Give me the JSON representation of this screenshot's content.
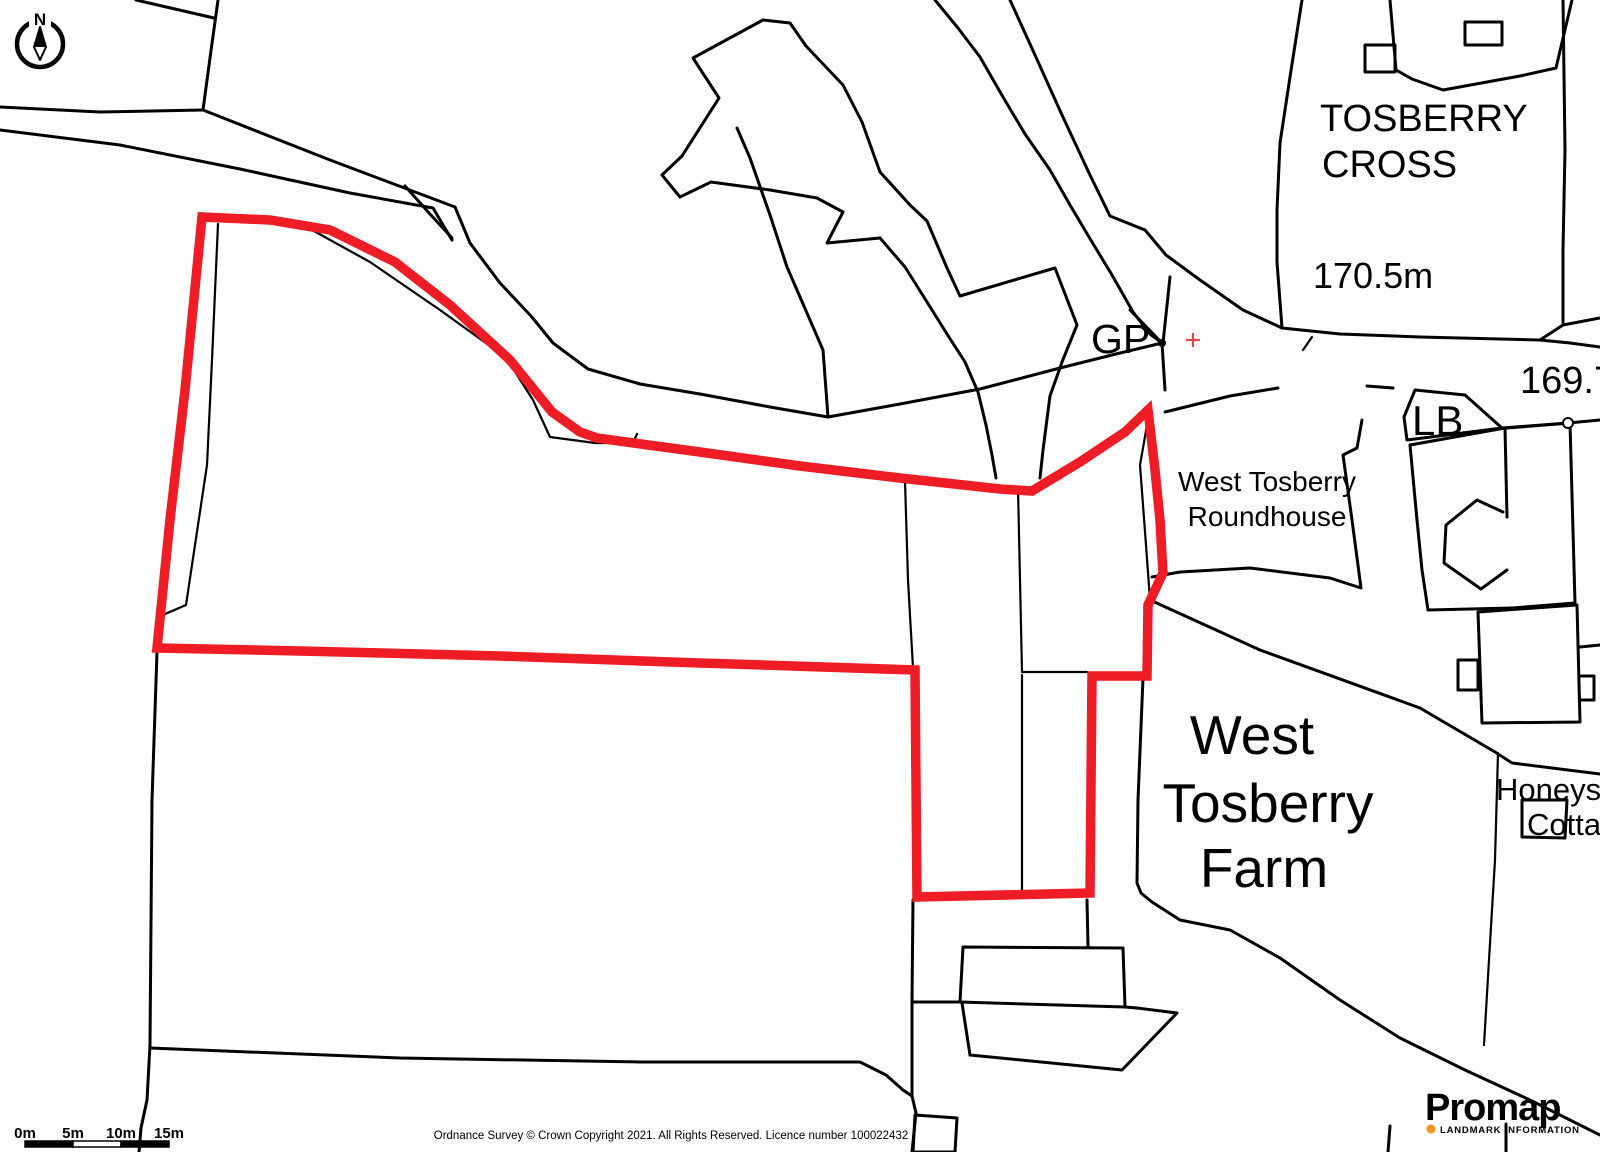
{
  "map": {
    "colors": {
      "background": "#ffffff",
      "line": "#000000",
      "boundary": "#ee1c25",
      "grid_cross": "#e2484e",
      "logo_text": "#3d3b3e",
      "logo_accent": "#f7941e"
    },
    "north_arrow": {
      "label": "N",
      "cx": 40,
      "cy": 44,
      "r": 23
    },
    "gp_dot": {
      "x": 1162,
      "y": 343,
      "r": 4
    },
    "grid_cross": {
      "x": 1193,
      "y": 340,
      "arm": 7
    },
    "post_circle": {
      "x": 1568,
      "y": 423,
      "r": 5
    },
    "labels": [
      {
        "name": "label-tosberry-cross-line1",
        "text": "TOSBERRY",
        "x": 1320,
        "y": 131,
        "size": 38
      },
      {
        "name": "label-tosberry-cross-line2",
        "text": "CROSS",
        "x": 1322,
        "y": 177,
        "size": 38
      },
      {
        "name": "label-spot-height-170",
        "text": "170.5m",
        "x": 1313,
        "y": 288,
        "size": 36
      },
      {
        "name": "label-gp",
        "text": "GP",
        "x": 1091,
        "y": 353,
        "size": 41
      },
      {
        "name": "label-spot-height-169",
        "text": "169.7m",
        "x": 1520,
        "y": 393,
        "size": 38
      },
      {
        "name": "label-lb",
        "text": "LB",
        "x": 1412,
        "y": 435,
        "size": 42
      },
      {
        "name": "label-roundhouse-line1",
        "text": "West Tosberry",
        "x": 1267,
        "y": 491,
        "size": 28,
        "anchor": "middle"
      },
      {
        "name": "label-roundhouse-line2",
        "text": "Roundhouse",
        "x": 1267,
        "y": 526,
        "size": 28,
        "anchor": "middle"
      },
      {
        "name": "label-farm-line1",
        "text": "West",
        "x": 1252,
        "y": 754,
        "size": 55,
        "anchor": "middle"
      },
      {
        "name": "label-farm-line2",
        "text": "Tosberry",
        "x": 1268,
        "y": 822,
        "size": 55,
        "anchor": "middle"
      },
      {
        "name": "label-farm-line3",
        "text": "Farm",
        "x": 1264,
        "y": 887,
        "size": 55,
        "anchor": "middle"
      },
      {
        "name": "label-honeysuckle-line1",
        "text": "Honeysuckle",
        "x": 1496,
        "y": 800,
        "size": 31
      },
      {
        "name": "label-honeysuckle-line2",
        "text": "Cottage",
        "x": 1527,
        "y": 835,
        "size": 31
      }
    ],
    "black_lines": [
      {
        "name": "field-boundary",
        "points": "218,0 210,58 203,110"
      },
      {
        "name": "field-boundary",
        "points": "136,0 175,9 214,18"
      },
      {
        "name": "road-edge",
        "points": "0,107 100,112 203,110"
      },
      {
        "name": "road-edge",
        "points": "203,110 330,160 455,207"
      },
      {
        "name": "road-edge",
        "points": "0,130 120,145 240,169 350,193 433,208 452,240"
      },
      {
        "name": "road-junction-line",
        "points": "405,186 430,214 452,238"
      },
      {
        "name": "road-edge",
        "points": "455,207 470,243 500,283 531,316 553,343 588,369 640,384 700,394 770,407 828,417"
      },
      {
        "name": "road-edge",
        "points": "828,417 900,404 980,389 1060,368 1120,353 1162,343"
      },
      {
        "name": "track-edge",
        "points": "828,417 823,350 810,320 787,267 770,215 750,158 737,128"
      },
      {
        "name": "field-boundary",
        "points": "218,224 212,360 207,465 186,605 165,614",
        "w": 2.2
      },
      {
        "name": "field-boundary",
        "points": "303,225 370,262 440,310 490,346 512,367 533,400 550,437 595,443 633,443 637,434",
        "w": 2.2
      },
      {
        "name": "pond-outline",
        "points": "763,20 693,58 719,98 682,156 662,175 680,197 711,182 770,190 817,198"
      },
      {
        "name": "pond-outline",
        "points": "763,20 790,23 806,46 843,85 862,122 880,172"
      },
      {
        "name": "stream-edge",
        "points": "880,172 910,205 927,221 947,268 960,296 1055,268 1077,325 1062,362 1050,396 1043,450 1040,478"
      },
      {
        "name": "pond-outline",
        "points": "817,198 843,212 827,243 880,238"
      },
      {
        "name": "stream-edge",
        "points": "880,238 905,267 927,302 947,334 965,362 978,392 986,425 992,455 996,478"
      },
      {
        "name": "track-edge",
        "points": "935,0 958,28 980,57 1003,97 1025,134 1050,170 1070,205 1092,242 1112,275 1133,312 1150,334 1162,343"
      },
      {
        "name": "track-edge",
        "points": "1010,0 1035,55 1062,115 1090,175 1110,216 1145,230 1166,255 1200,280 1243,310 1282,328"
      },
      {
        "name": "boundary-arm",
        "points": "1170,277 1163,343"
      },
      {
        "name": "boundary-arm",
        "points": "1130,310 1162,343"
      },
      {
        "name": "boundary-arm",
        "points": "1162,343 1165,390"
      },
      {
        "name": "parcel-edge",
        "points": "1302,0 1290,77 1280,143 1277,210 1277,262 1282,328"
      },
      {
        "name": "parcel-edge",
        "points": "1563,0 1565,150 1563,250 1563,323"
      },
      {
        "name": "road-edge",
        "points": "1282,328 1340,334 1420,337 1540,340 1563,325 1600,318"
      },
      {
        "name": "road-edge",
        "points": "1540,340 1570,343 1600,347"
      },
      {
        "name": "road-tick",
        "points": "1303,350 1312,337",
        "w": 2.2
      },
      {
        "name": "road-edge",
        "points": "1165,412 1230,396 1278,388"
      },
      {
        "name": "road-dash",
        "points": "1367,386 1393,388"
      },
      {
        "name": "road-edge",
        "points": "1502,428 1568,423 1600,420"
      },
      {
        "name": "building",
        "points": "1365,45 1395,45 1395,72 1365,72",
        "closed": true
      },
      {
        "name": "building",
        "points": "1465,22 1502,22 1502,45 1465,45",
        "closed": true
      },
      {
        "name": "building",
        "points": "1390,0 1396,70 1412,79 1443,90 1520,76 1556,68 1572,0"
      },
      {
        "name": "lb-enclosure",
        "points": "1415,390 1465,395 1502,428 1407,440 1404,417",
        "closed": true
      },
      {
        "name": "parcel-edge",
        "points": "1362,420 1357,448 1343,455 1352,520 1361,588 1330,578 1250,568 1180,572 1152,577"
      },
      {
        "name": "parcel-edge",
        "points": "1150,600 1260,650 1420,708 1495,752 1512,763 1600,774"
      },
      {
        "name": "building",
        "points": "1505,428 1410,445 1417,520 1422,570 1428,610 1512,608"
      },
      {
        "name": "building-division",
        "points": "1505,428 1507,517"
      },
      {
        "name": "building-c-shape",
        "points": "1503,512 1477,500 1446,525 1444,563 1481,589 1507,570"
      },
      {
        "name": "building",
        "points": "1507,428 1570,423 1575,603 1512,608"
      },
      {
        "name": "building",
        "points": "1478,612 1577,605 1580,722 1482,723",
        "closed": true
      },
      {
        "name": "building",
        "points": "1458,660 1478,660 1478,690 1458,690",
        "closed": true
      },
      {
        "name": "building",
        "points": "1580,647 1600,645"
      },
      {
        "name": "building",
        "points": "1580,676 1594,676 1594,700 1580,700"
      },
      {
        "name": "field-boundary",
        "points": "905,481 908,580 913,668",
        "w": 2.2
      },
      {
        "name": "field-boundary",
        "points": "1018,488 1022,672",
        "w": 2.2
      },
      {
        "name": "field-boundary",
        "points": "1022,672 1087,672",
        "w": 2.2
      },
      {
        "name": "field-boundary",
        "points": "1022,675 1022,890",
        "w": 2.2
      },
      {
        "name": "field-boundary",
        "points": "1150,408 1140,465 1146,545 1150,600",
        "w": 2.2
      },
      {
        "name": "field-boundary",
        "points": "913,900 912,1000 912,1096 916,1113 912,1152"
      },
      {
        "name": "field-boundary",
        "points": "1087,900 1088,947"
      },
      {
        "name": "building",
        "points": "963,947 1123,948 1125,1007 960,1002",
        "closed": true
      },
      {
        "name": "field-boundary",
        "points": "960,1002 913,1002"
      },
      {
        "name": "parcel-edge",
        "points": "1125,1007 1137,1008 1177,1013 1122,1070 970,1055"
      },
      {
        "name": "parcel-edge",
        "points": "970,1055 962,1003"
      },
      {
        "name": "building",
        "points": "915,1115 957,1118 955,1152 913,1152",
        "closed": true
      },
      {
        "name": "parcel-edge",
        "points": "1143,678 1138,800 1137,883 1141,893 1152,902 1180,920 1230,930 1280,958"
      },
      {
        "name": "parcel-edge",
        "points": "1280,958 1340,1000 1400,1038 1465,1070 1530,1100 1600,1135"
      },
      {
        "name": "field-boundary",
        "points": "1498,753 1495,860 1489,960 1484,1045",
        "w": 2.2
      },
      {
        "name": "field-boundary",
        "points": "1390,1126 1388,1152"
      },
      {
        "name": "field-boundary",
        "points": "1506,1124 1506,1152"
      },
      {
        "name": "building",
        "points": "1522,800 1567,800 1565,838 1522,837",
        "closed": true
      },
      {
        "name": "field-boundary",
        "points": "157,652 152,800 150,1045 147,1100 141,1128 139,1152"
      },
      {
        "name": "field-boundary",
        "points": "150,1048 400,1058 640,1062 860,1062 886,1075 903,1090 912,1096"
      }
    ],
    "red_boundary": {
      "name": "site-boundary",
      "points": "202,217 270,220 330,230 395,262 450,305 510,360 552,412 580,432 597,438 700,452 800,466 900,478 1000,489 1032,491 1080,462 1125,432 1148,410 1155,470 1160,520 1163,573 1148,605 1147,676 1092,676 1090,893 917,897 915,670 700,663 500,656 300,651 157,648 170,520 185,390",
      "width": 9.5
    },
    "scale_bar": {
      "x": 25,
      "y": 1141,
      "h": 6,
      "segment_w": 48,
      "labels": [
        "0m",
        "5m",
        "10m",
        "15m"
      ],
      "label_y": 1138,
      "label_size": 15
    },
    "copyright": "Ordnance Survey © Crown Copyright 2021. All Rights Reserved. Licence number 100022432",
    "copyright_pos": {
      "x": 671,
      "y": 1139,
      "size": 11.5
    },
    "logo": {
      "title": "Promap",
      "tagline": "LANDMARK INFORMATION",
      "x": 1425,
      "y": 1120,
      "title_size": 38,
      "tagline_x": 1440,
      "tagline_y": 1133,
      "tagline_size": 9.5,
      "dot_x": 1431,
      "dot_y": 1129,
      "dot_r": 4.5
    }
  }
}
